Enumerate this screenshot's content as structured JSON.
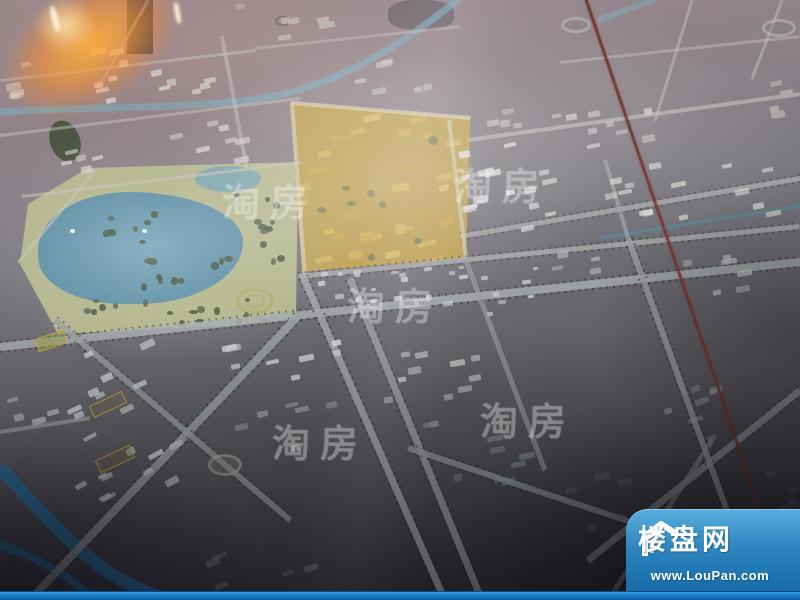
{
  "branding": {
    "watermark_text": "淘房",
    "logo": {
      "site_name": "楼盘网",
      "site_url": "www.LouPan.com"
    }
  },
  "colors": {
    "logo_blue_top": "#57aede",
    "logo_blue_bottom": "#176ba8",
    "park_green": "#b5b88c",
    "lake_blue": "#6f9fb3",
    "development_gold": "#bfa04c",
    "river_blue": "#2f72a2",
    "upper_river_teal": "#7fa9b8",
    "red_line": "#7a332c",
    "road_gray": "#a6aaac",
    "building_white": "#dcdcd8"
  }
}
